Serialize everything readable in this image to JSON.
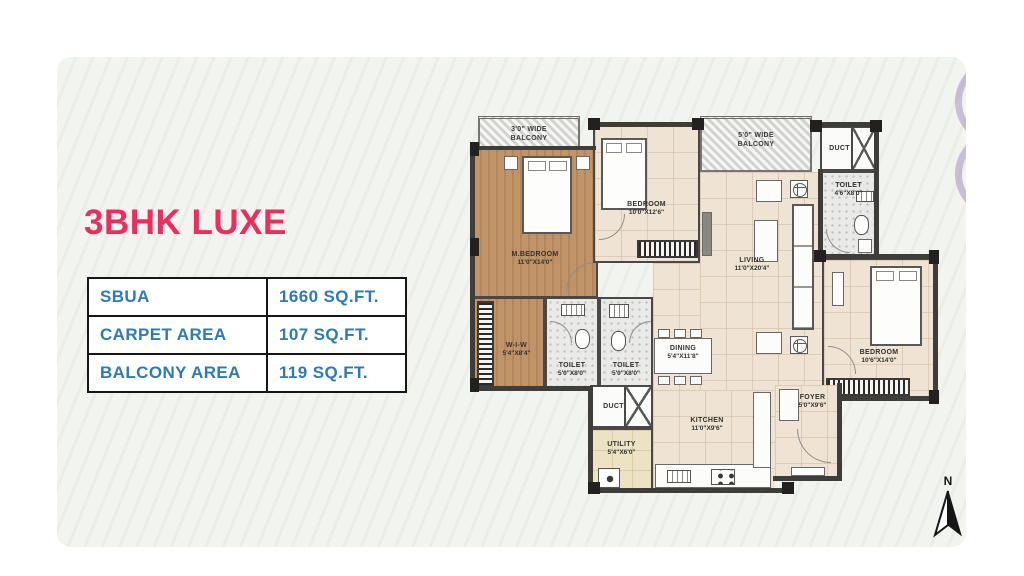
{
  "title": "3BHK LUXE",
  "areas": {
    "rows": [
      {
        "label": "SBUA",
        "value": "1660 SQ.FT."
      },
      {
        "label": "CARPET AREA",
        "value": "107 SQ.FT."
      },
      {
        "label": "BALCONY AREA",
        "value": "119 SQ.FT."
      }
    ]
  },
  "plan": {
    "rooms": {
      "balcony_left": {
        "name": "3'0\" WIDE BALCONY"
      },
      "balcony_right": {
        "name": "5'0\" WIDE BALCONY"
      },
      "m_bedroom": {
        "name": "M.BEDROOM",
        "dims": "11'0\"X14'0\""
      },
      "bedroom_2": {
        "name": "BEDROOM",
        "dims": "10'0\"X12'6\""
      },
      "bedroom_3": {
        "name": "BEDROOM",
        "dims": "10'6\"X14'0\""
      },
      "living": {
        "name": "LIVING",
        "dims": "11'0\"X20'4\""
      },
      "dining": {
        "name": "DINING",
        "dims": "5'4\"X11'8\""
      },
      "kitchen": {
        "name": "KITCHEN",
        "dims": "11'0\"X9'6\""
      },
      "foyer": {
        "name": "FOYER",
        "dims": "5'0\"X9'6\""
      },
      "utility": {
        "name": "UTILITY",
        "dims": "5'4\"X6'0\""
      },
      "wiw": {
        "name": "W-I-W",
        "dims": "5'4\"X8'4\""
      },
      "toilet_mbr": {
        "name": "TOILET",
        "dims": "5'0\"X8'0\""
      },
      "toilet_common": {
        "name": "TOILET",
        "dims": "5'0\"X8'0\""
      },
      "toilet_right": {
        "name": "TOILET",
        "dims": "4'6\"X8'0\""
      },
      "duct_top": {
        "name": "DUCT"
      },
      "duct_mid": {
        "name": "DUCT"
      }
    }
  },
  "compass": {
    "label": "N"
  },
  "colors": {
    "accent_pink": "#EE2D5E",
    "table_text_blue": "#2E79B8",
    "panel_background": "#F2F4F0",
    "wall_dark": "#3F3D3A",
    "wood_floor": "#C09468",
    "tile_beige": "#EFE3D3",
    "decor_purple": "#9A84BB"
  }
}
